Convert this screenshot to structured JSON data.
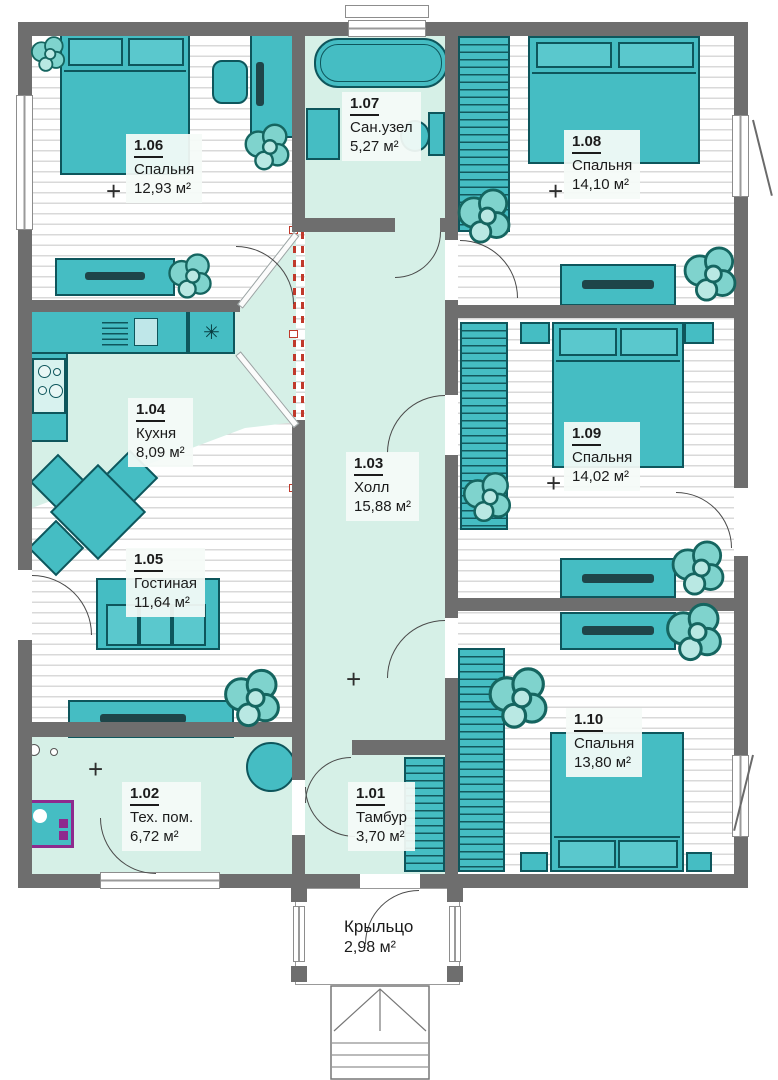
{
  "plan_type": "floor-plan",
  "rooms": [
    {
      "num": "1.06",
      "name": "Спальня",
      "area": "12,93 м²"
    },
    {
      "num": "1.07",
      "name": "Сан.узел",
      "area": "5,27 м²"
    },
    {
      "num": "1.08",
      "name": "Спальня",
      "area": "14,10 м²"
    },
    {
      "num": "1.04",
      "name": "Кухня",
      "area": "8,09 м²"
    },
    {
      "num": "1.03",
      "name": "Холл",
      "area": "15,88 м²"
    },
    {
      "num": "1.09",
      "name": "Спальня",
      "area": "14,02 м²"
    },
    {
      "num": "1.05",
      "name": "Гостиная",
      "area": "11,64 м²"
    },
    {
      "num": "1.02",
      "name": "Тех. пом.",
      "area": "6,72 м²"
    },
    {
      "num": "1.01",
      "name": "Тамбур",
      "area": "3,70 м²"
    },
    {
      "num": "1.10",
      "name": "Спальня",
      "area": "13,80 м²"
    }
  ],
  "porch": {
    "name": "Крыльцо",
    "area": "2,98 м²"
  },
  "symbols": {
    "plus": "+",
    "snowflake": "✳"
  },
  "colors": {
    "wall": "#6e6e6e",
    "furniture": "#45bdc3",
    "furniture_outline": "#0e565c",
    "floor_mint": "#d6f0e7",
    "floor_stripe": "#d9d9d9",
    "label_bg": "#f5fbf8",
    "accent_red": "#c0392b",
    "equipment_purple": "#8e2a8e",
    "tv_dark": "#1e4549"
  }
}
